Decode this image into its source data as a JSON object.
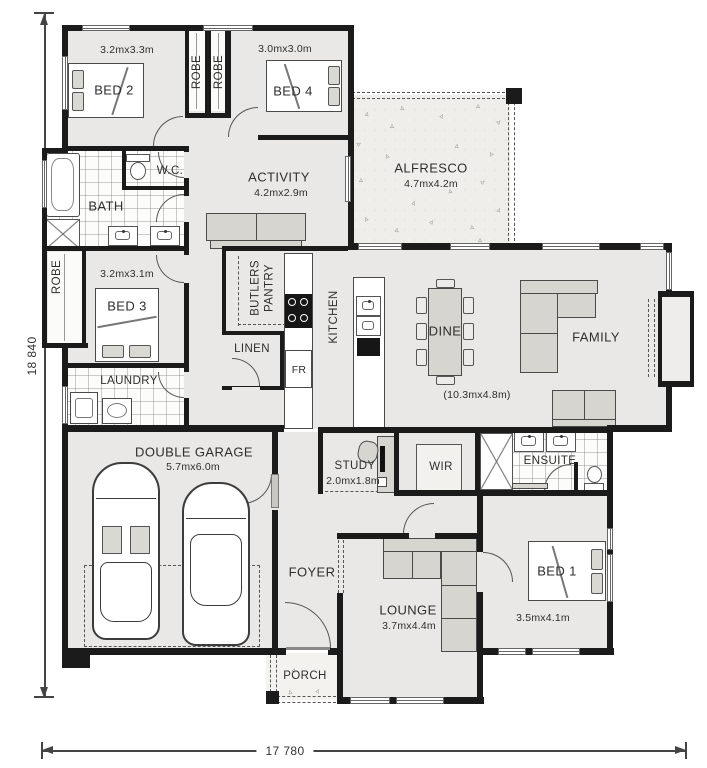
{
  "labels": {
    "bed2": {
      "name": "BED 2",
      "size": "3.2mx3.3m"
    },
    "robe_left": {
      "name": "ROBE"
    },
    "robe_right": {
      "name": "ROBE"
    },
    "bed4": {
      "name": "BED 4",
      "size": "3.0mx3.0m"
    },
    "alfresco": {
      "name": "ALFRESCO",
      "size": "4.7mx4.2m"
    },
    "wc": {
      "name": "W.C."
    },
    "bath": {
      "name": "BATH"
    },
    "activity": {
      "name": "ACTIVITY",
      "size": "4.2mx2.9m"
    },
    "robe_bed3": {
      "name": "ROBE"
    },
    "bed3": {
      "name": "BED 3",
      "size": "3.2mx3.1m"
    },
    "laundry": {
      "name": "LAUNDRY"
    },
    "butlers_pantry": {
      "name": "BUTLERS PANTRY"
    },
    "linen": {
      "name": "LINEN"
    },
    "fridge": {
      "name": "FR"
    },
    "kitchen": {
      "name": "KITCHEN"
    },
    "dine": {
      "name": "DINE"
    },
    "family": {
      "name": "FAMILY"
    },
    "living_size": {
      "name": "(10.3mx4.8m)"
    },
    "garage": {
      "name": "DOUBLE GARAGE",
      "size": "5.7mx6.0m"
    },
    "study": {
      "name": "STUDY",
      "size": "2.0mx1.8m"
    },
    "wir": {
      "name": "WIR"
    },
    "ensuite": {
      "name": "ENSUITE"
    },
    "foyer": {
      "name": "FOYER"
    },
    "lounge": {
      "name": "LOUNGE",
      "size": "3.7mx4.4m"
    },
    "bed1": {
      "name": "BED 1",
      "size": "3.5mx4.1m"
    },
    "porch": {
      "name": "PORCH"
    }
  },
  "overall_dimensions": {
    "depth": "18 840",
    "width": "17 780"
  },
  "colors": {
    "wall": "#1b1b1b",
    "floor": "#e9e8e6",
    "furniture": "#d6d5cf"
  }
}
